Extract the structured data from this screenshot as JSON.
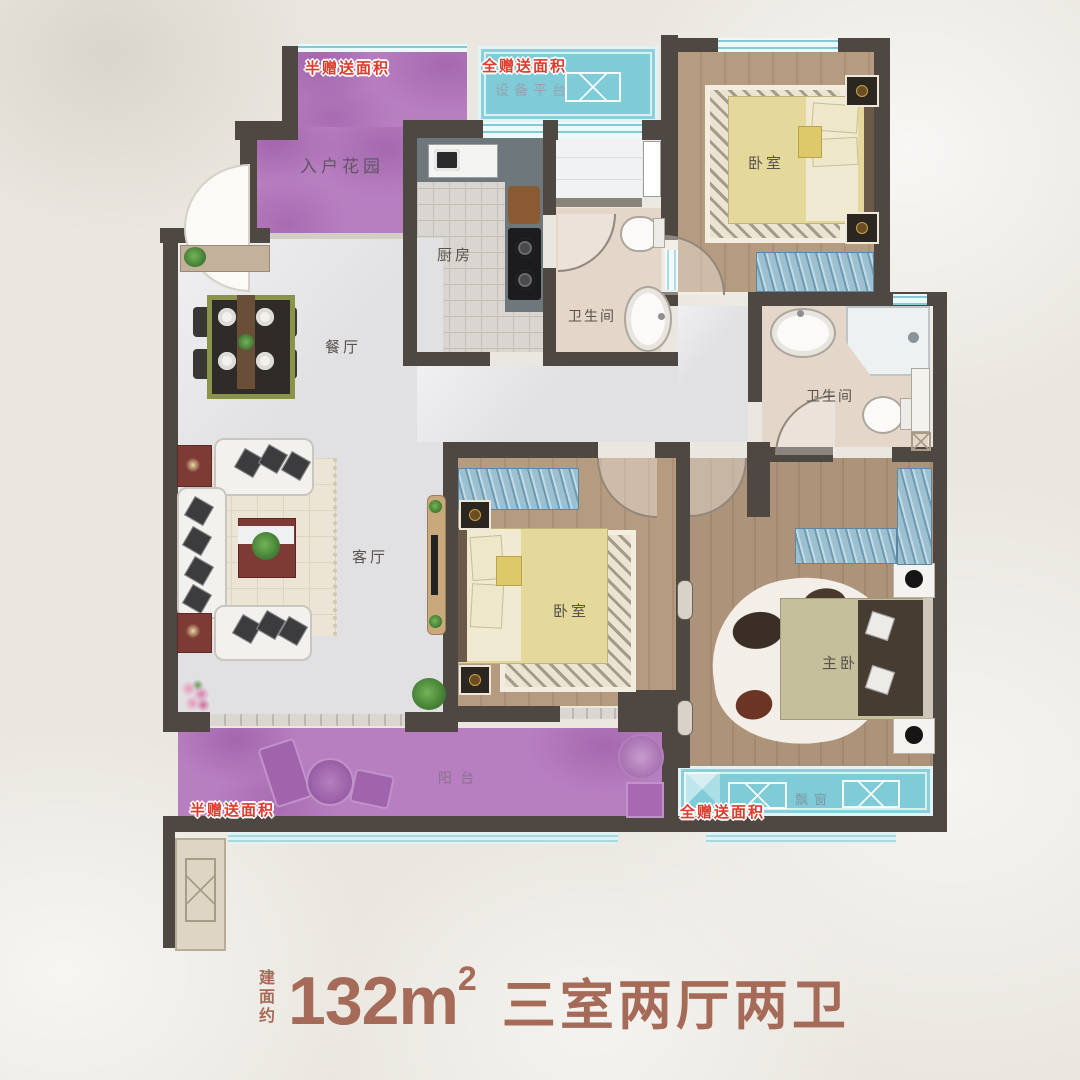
{
  "poster": {
    "caption_prefix": "建面约",
    "caption_area": "132m",
    "caption_area_sup": "2",
    "caption_layout": "三室两厅两卫"
  },
  "gift_labels": {
    "top_left": "半赠送面积",
    "top_center": "全赠送面积",
    "bottom_left": "半赠送面积",
    "bottom_right": "全赠送面积"
  },
  "rooms": {
    "equipment_platform": "设备平台",
    "entry_garden": "入户花园",
    "kitchen": "厨房",
    "bath_top": "卫生间",
    "bath_master": "卫生间",
    "bedroom_top": "卧室",
    "bedroom_mid": "卧室",
    "master_bedroom": "主卧",
    "dining": "餐厅",
    "living": "客厅",
    "balcony": "阳台",
    "bay_window": "飘窗"
  },
  "colors": {
    "wall": "#4f4742",
    "gift_purple": "#b77fc0",
    "gift_cyan": "#7fccd8",
    "red_label": "#e23a2c",
    "caption": "#a56b58"
  }
}
